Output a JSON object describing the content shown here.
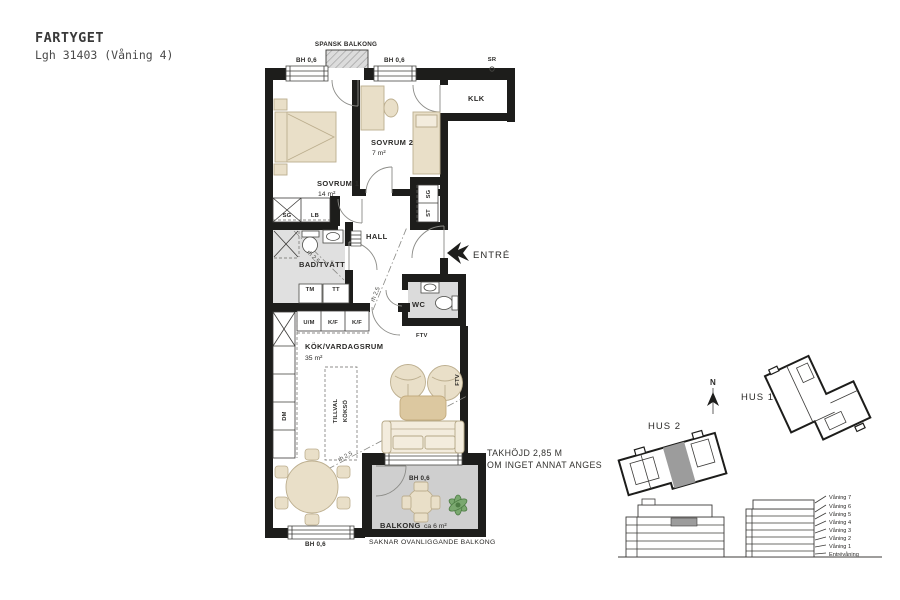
{
  "header": {
    "project": "FARTYGET",
    "apartment_line": "Lgh 31403 (Våning 4)"
  },
  "floorplan": {
    "rooms": {
      "sovrum1": {
        "name": "SOVRUM 1",
        "area": "14 m²"
      },
      "sovrum2": {
        "name": "SOVRUM 2",
        "area": "7 m²"
      },
      "bad": {
        "name": "BAD/TVÄTT"
      },
      "hall": {
        "name": "HALL"
      },
      "wc": {
        "name": "WC"
      },
      "kok": {
        "name": "KÖK/VARDAGSRUM",
        "area": "35 m²"
      },
      "klk": {
        "name": "KLK"
      },
      "balkong": {
        "name": "BALKONG",
        "area": "ca 6 m²"
      }
    },
    "labels": {
      "spansk_balkong": "SPANSK BALKONG",
      "bh06": "BH 0,6",
      "sr": "SR",
      "sg": "SG",
      "lb": "LB",
      "st": "ST",
      "tm": "TM",
      "tt": "TT",
      "um": "U/M",
      "kf": "K/F",
      "dm": "DM",
      "ftv": "FTV",
      "entre": "ENTRÉ",
      "rh25": "rh 2,5",
      "tillval_line1": "TILLVAL",
      "tillval_line2": "KÖKSÖ",
      "saknar": "SAKNAR OVANLIGGANDE BALKONG"
    },
    "notes": {
      "takhojd_line1": "TAKHÖJD 2,85 M",
      "takhojd_line2": "OM INGET ANNAT ANGES"
    }
  },
  "siteplan": {
    "north": "N",
    "hus1": "HUS 1",
    "hus2": "HUS 2"
  },
  "elevation": {
    "floors": [
      "Våning 7",
      "Våning 6",
      "Våning 5",
      "Våning 4",
      "Våning 3",
      "Våning 2",
      "Våning 1",
      "Entrévåning"
    ]
  },
  "colors": {
    "wall": "#1d1d1b",
    "furniture_tan": "#e9dfc8",
    "table_tan": "#dcc8a0",
    "floor_gray": "#dedede",
    "balcony_gray": "#cfcfcf",
    "unit_highlight_gray": "#9c9c9c",
    "plant_green": "#4e7d45",
    "text": "#2b2a28"
  }
}
